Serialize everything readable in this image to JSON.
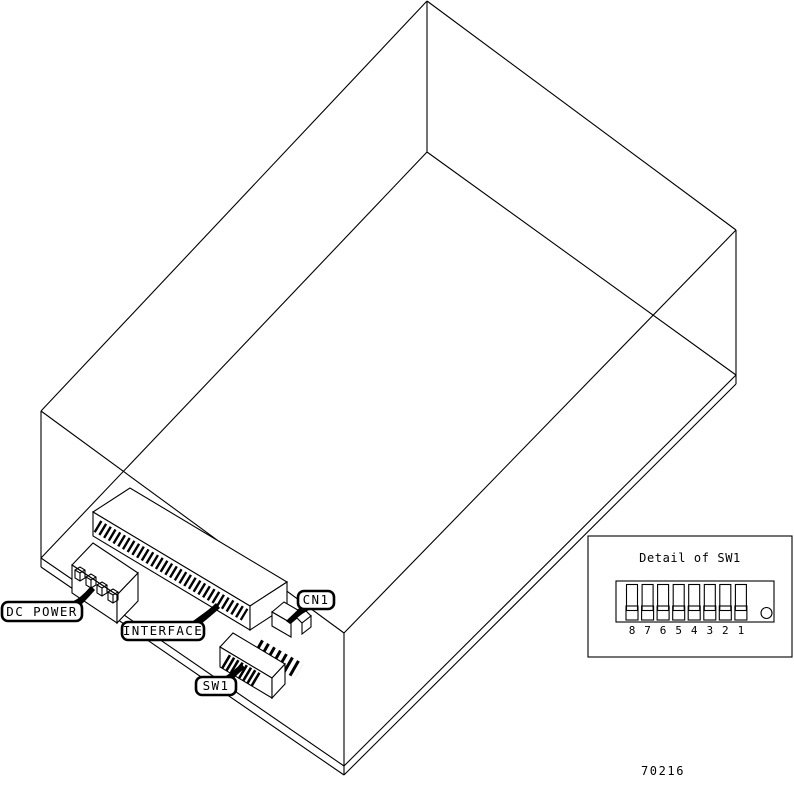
{
  "colors": {
    "ink": "#000000",
    "paper": "#ffffff"
  },
  "drawing": {
    "description_labels": {
      "dc_power": "DC POWER",
      "interface": "INTERFACE",
      "cn1": "CN1",
      "sw1": "SW1"
    }
  },
  "detail_inset": {
    "title": "Detail of SW1",
    "switch_labels": [
      "8",
      "7",
      "6",
      "5",
      "4",
      "3",
      "2",
      "1"
    ]
  },
  "figure_number": "70216"
}
